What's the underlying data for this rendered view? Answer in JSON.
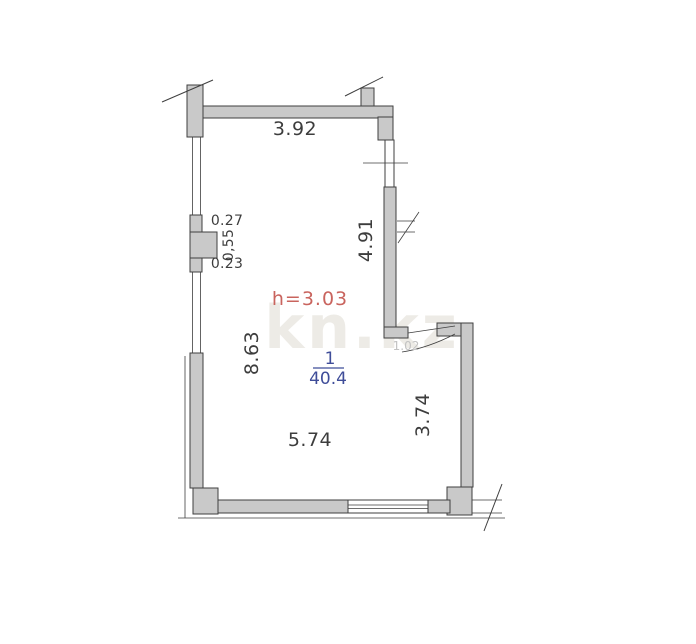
{
  "plan": {
    "watermark": "kn.kz",
    "height_label": "h=3.03",
    "room": {
      "number": "1",
      "area": "40.4"
    },
    "dimensions": {
      "top_wall": "3.92",
      "pilaster_top": "0.27",
      "pilaster_side": "0,55",
      "pilaster_bottom": "0.23",
      "right_upper_wall": "4.91",
      "left_wall": "8.63",
      "bottom_wall": "5.74",
      "right_lower_wall": "3.74",
      "door_width": "1.02"
    },
    "colors": {
      "wall_fill": "#c9c9c9",
      "wall_outline": "#3f3f3f",
      "dimension_text": "#3d3d3d",
      "height_text": "#c9645e",
      "room_text": "#3f4d99",
      "door_faint_text": "#c2c2c2",
      "watermark": "#edebe6"
    }
  }
}
